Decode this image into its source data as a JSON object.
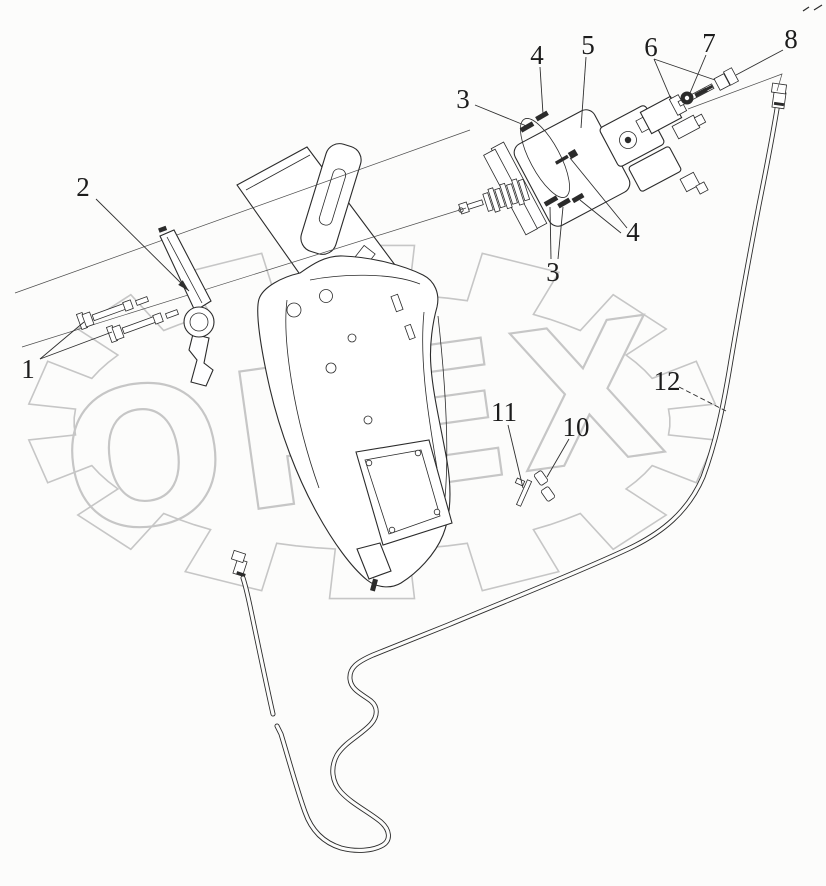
{
  "canvas": {
    "width": 826,
    "height": 886,
    "background": "#fcfcfb"
  },
  "style": {
    "line_color": "#2b2b2b",
    "construction_line_color": "#4d4d4d",
    "leader_color": "#2f2f2f",
    "label_color": "#1c1c1c",
    "label_font_size": 27
  },
  "watermark": {
    "text": "OPEX",
    "color": "#c6c6c6",
    "text_rotation_deg": -8,
    "text_font_size": 190,
    "text_x": 366,
    "text_y": 493,
    "gear": {
      "cx": 372,
      "cy": 422,
      "outer_rx": 345,
      "outer_ry": 178,
      "root_rx": 298,
      "root_ry": 128,
      "teeth": 14,
      "tooth_fraction": 0.55
    }
  },
  "corner_marks": [
    [
      803,
      11,
      809,
      7
    ],
    [
      814,
      10,
      822,
      5
    ]
  ],
  "callouts": [
    {
      "label": "1",
      "x": 28,
      "y": 378,
      "leaders": [
        [
          40,
          359,
          84,
          322
        ],
        [
          40,
          359,
          112,
          332
        ]
      ]
    },
    {
      "label": "2",
      "x": 83,
      "y": 196,
      "leaders": [
        [
          96,
          199,
          189,
          291
        ]
      ],
      "arrow_on": 0
    },
    {
      "label": "3",
      "x": 463,
      "y": 108,
      "leaders": [
        [
          475,
          105,
          529,
          127
        ]
      ]
    },
    {
      "label": "4",
      "x": 537,
      "y": 64,
      "leaders": [
        [
          540,
          67,
          543,
          114
        ]
      ]
    },
    {
      "label": "5",
      "x": 588,
      "y": 54,
      "leaders": [
        [
          586,
          57,
          581,
          128
        ]
      ]
    },
    {
      "label": "6",
      "x": 651,
      "y": 56,
      "leaders": [
        [
          654,
          59,
          671,
          99
        ],
        [
          654,
          59,
          715,
          80
        ]
      ]
    },
    {
      "label": "7",
      "x": 709,
      "y": 52,
      "leaders": [
        [
          706,
          55,
          690,
          93
        ]
      ]
    },
    {
      "label": "8",
      "x": 791,
      "y": 48,
      "leaders": [
        [
          783,
          50,
          736,
          75
        ]
      ]
    },
    {
      "label": "3",
      "x": 553,
      "y": 281,
      "leaders": [
        [
          551,
          259,
          550,
          207
        ],
        [
          558,
          259,
          563,
          207
        ]
      ]
    },
    {
      "label": "4",
      "x": 633,
      "y": 241,
      "leaders": [
        [
          627,
          228,
          570,
          158
        ],
        [
          621,
          233,
          580,
          200
        ]
      ]
    },
    {
      "label": "11",
      "x": 504,
      "y": 421,
      "leaders": [
        [
          508,
          425,
          523,
          488
        ]
      ]
    },
    {
      "label": "10",
      "x": 576,
      "y": 436,
      "leaders": [
        [
          569,
          439,
          547,
          477
        ]
      ]
    },
    {
      "label": "12",
      "x": 667,
      "y": 390,
      "leaders": [
        [
          679,
          387,
          726,
          411
        ]
      ],
      "dash_on": 0
    }
  ]
}
